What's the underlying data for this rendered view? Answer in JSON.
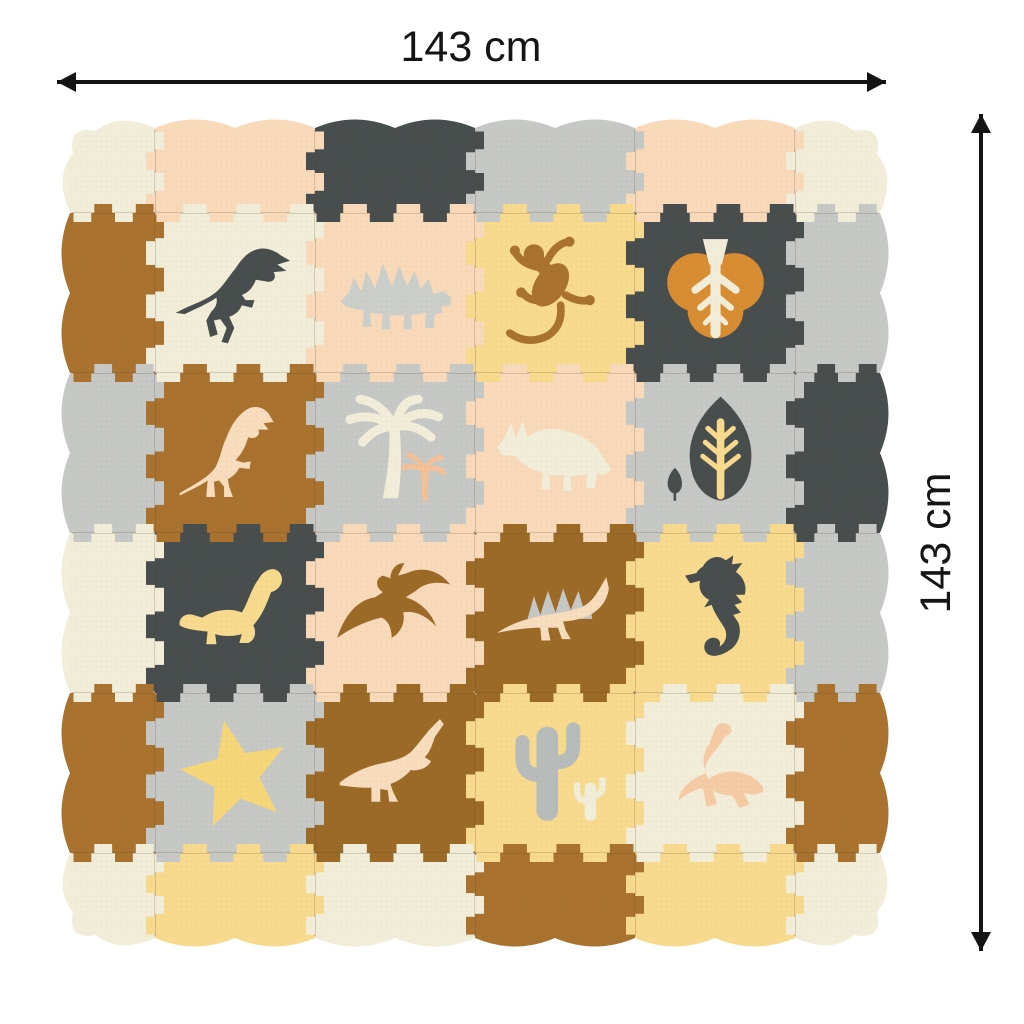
{
  "product": {
    "name": "foam-puzzle-play-mat",
    "description": "Interlocking foam puzzle play mat with dinosaur tiles and wavy border"
  },
  "dimensions": {
    "width_label": "143 cm",
    "height_label": "143 cm"
  },
  "palette": {
    "background": "#ffffff",
    "arrow": "#141414",
    "seam": "rgba(82,62,40,0.20)",
    "cream": "#f1edd9",
    "peach": "#f8d9ba",
    "dark_gray": "#484d4d",
    "light_gray": "#c6c8c5",
    "pale_gray": "#cccec9",
    "yellow": "#f7da8d",
    "brown": "#a9722e",
    "dark_brown": "#9c6a27",
    "orange": "#d88d33",
    "star_yellow": "#f5d678",
    "cactus_gray": "#b7bcba",
    "peach_light": "#f7dcbd",
    "peach_deep": "#f3c197",
    "peach_pink": "#f5cba6"
  },
  "mat": {
    "grid": {
      "rows": 4,
      "cols": 4
    },
    "border": {
      "corners": {
        "top_left": "cream",
        "top_right": "cream",
        "bottom_right": "cream",
        "bottom_left": "cream"
      },
      "top": [
        "peach",
        "dark_gray",
        "light_gray",
        "peach"
      ],
      "right": [
        "light_gray",
        "dark_gray",
        "light_gray",
        "brown"
      ],
      "bottom": [
        "yellow",
        "cream",
        "brown",
        "yellow"
      ],
      "left": [
        "brown",
        "light_gray",
        "cream",
        "brown"
      ]
    },
    "tiles": [
      {
        "row": 1,
        "col": 1,
        "bg": "cream",
        "figure": "tyrannosaurus",
        "figure_color": "dark_gray"
      },
      {
        "row": 1,
        "col": 2,
        "bg": "peach",
        "figure": "stegosaurus",
        "figure_color": "pale_gray"
      },
      {
        "row": 1,
        "col": 3,
        "bg": "yellow",
        "figure": "lizard",
        "figure_color": "brown"
      },
      {
        "row": 1,
        "col": 4,
        "bg": "dark_gray",
        "figure": "leaf",
        "figure_color": "orange",
        "accent_color": "cream"
      },
      {
        "row": 2,
        "col": 1,
        "bg": "brown",
        "figure": "tyrannosaurus-standing",
        "figure_color": "peach_light"
      },
      {
        "row": 2,
        "col": 2,
        "bg": "light_gray",
        "figure": "palm-trees",
        "figure_color": "cream",
        "accent_color": "peach_deep"
      },
      {
        "row": 2,
        "col": 3,
        "bg": "peach",
        "figure": "triceratops",
        "figure_color": "cream"
      },
      {
        "row": 2,
        "col": 4,
        "bg": "light_gray",
        "figure": "tree-leaf",
        "figure_color": "dark_gray",
        "accent_color": "yellow"
      },
      {
        "row": 3,
        "col": 1,
        "bg": "dark_gray",
        "figure": "sauropod",
        "figure_color": "yellow"
      },
      {
        "row": 3,
        "col": 2,
        "bg": "peach",
        "figure": "pterodactyl",
        "figure_color": "dark_brown"
      },
      {
        "row": 3,
        "col": 3,
        "bg": "dark_brown",
        "figure": "spinosaurus",
        "figure_color": "peach_light",
        "accent_color": "light_gray"
      },
      {
        "row": 3,
        "col": 4,
        "bg": "yellow",
        "figure": "seahorse",
        "figure_color": "dark_gray"
      },
      {
        "row": 4,
        "col": 1,
        "bg": "light_gray",
        "figure": "star",
        "figure_color": "star_yellow"
      },
      {
        "row": 4,
        "col": 2,
        "bg": "dark_brown",
        "figure": "parasaurolophus",
        "figure_color": "peach_light"
      },
      {
        "row": 4,
        "col": 3,
        "bg": "yellow",
        "figure": "cactus",
        "figure_color": "cactus_gray",
        "accent_color": "cream"
      },
      {
        "row": 4,
        "col": 4,
        "bg": "cream",
        "figure": "plesiosaurus",
        "figure_color": "peach_pink"
      }
    ]
  }
}
